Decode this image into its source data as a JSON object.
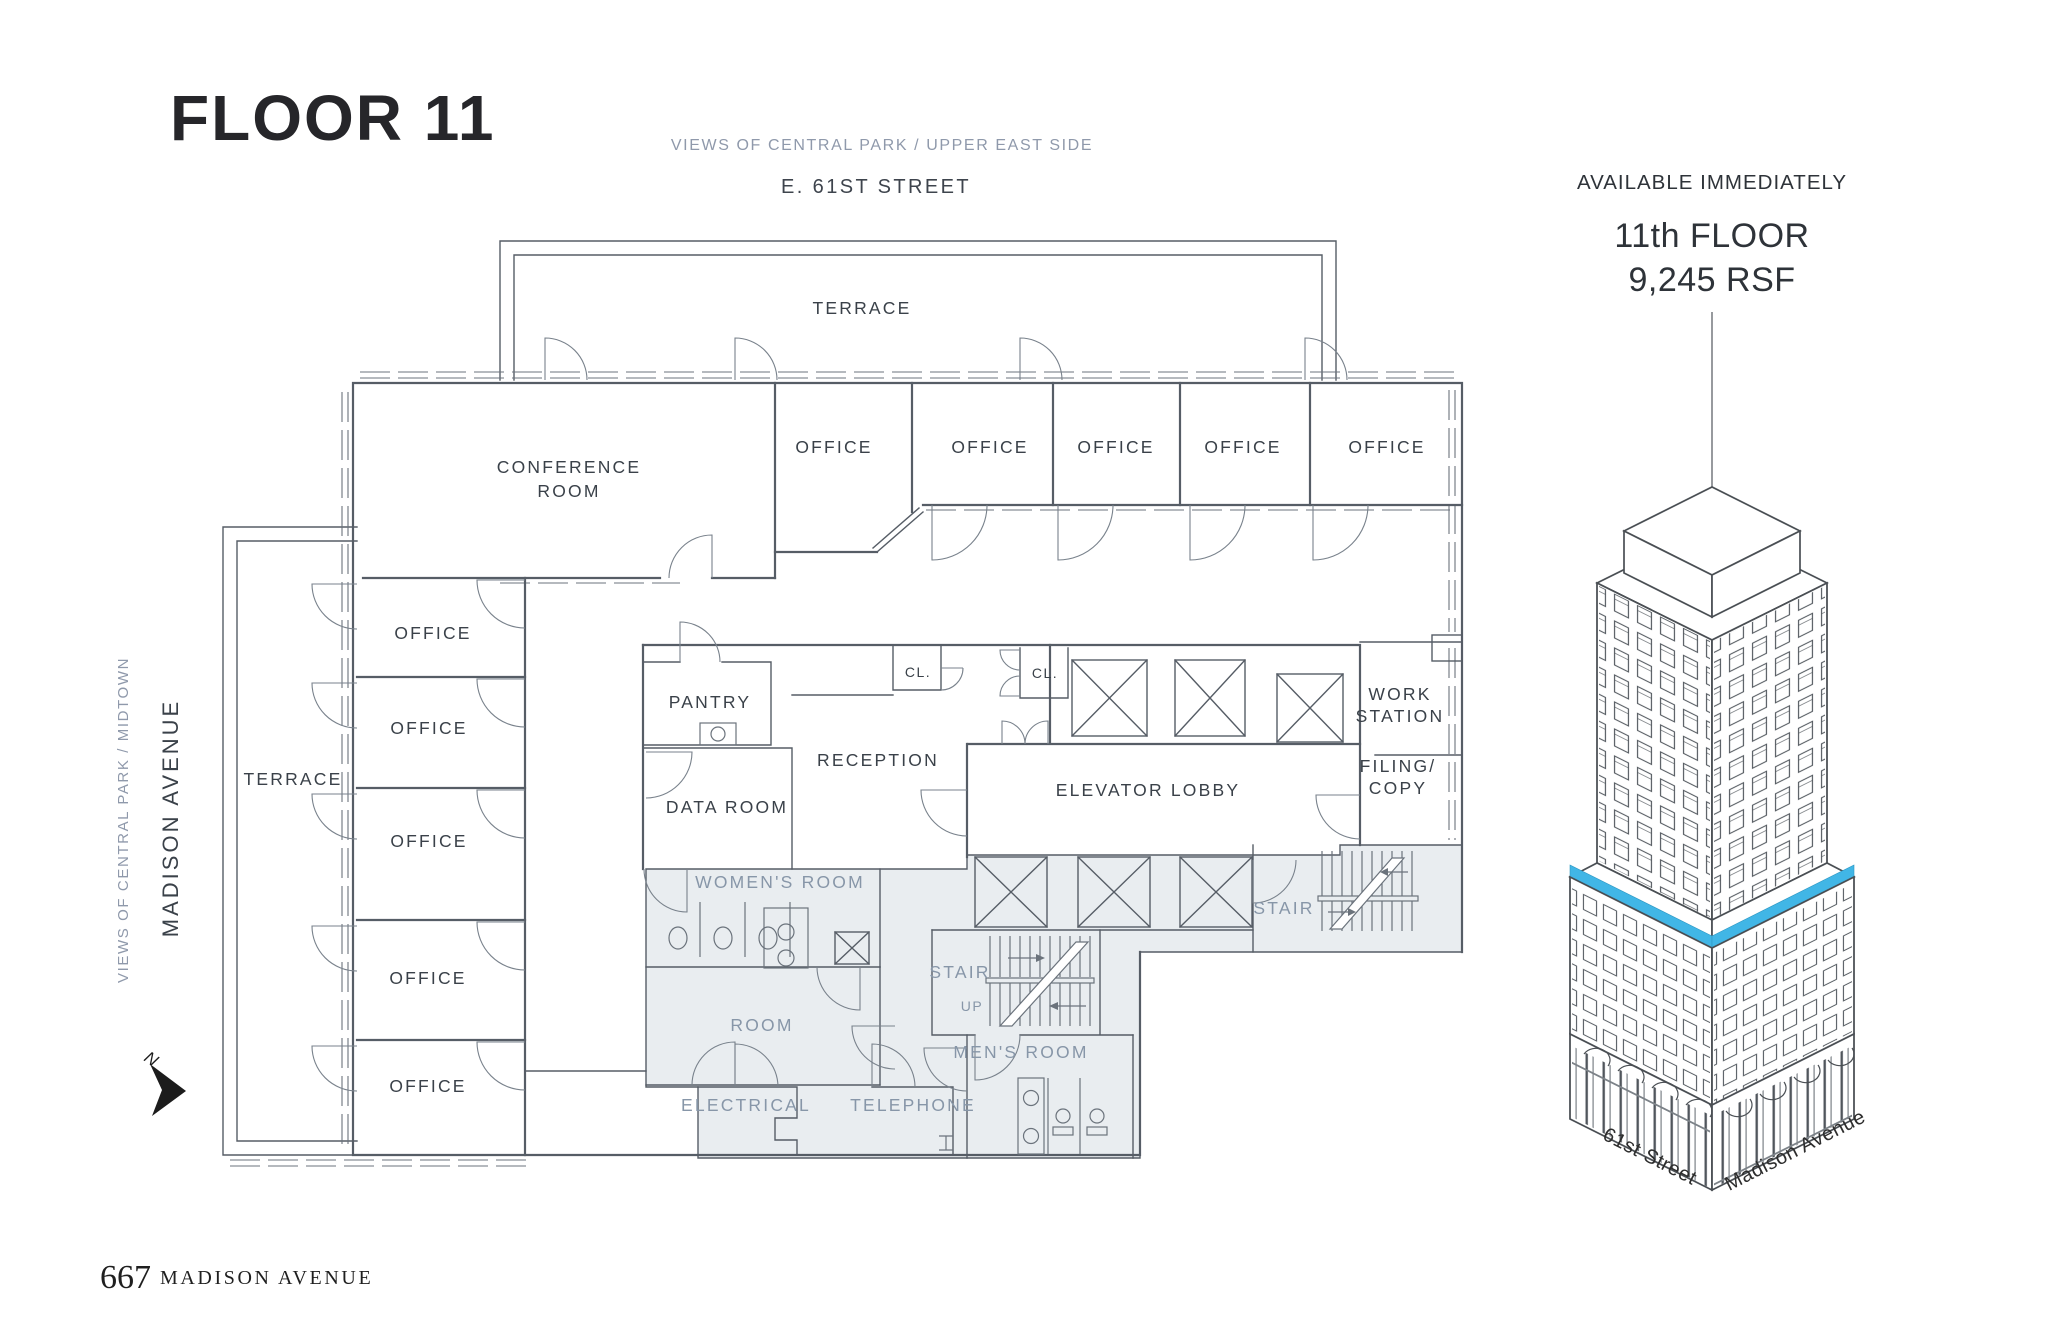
{
  "header": {
    "title": "FLOOR 11",
    "views_note": "VIEWS OF CENTRAL PARK / UPPER EAST SIDE",
    "street": "E. 61ST STREET"
  },
  "availability": {
    "status": "AVAILABLE IMMEDIATELY",
    "floor": "11th FLOOR",
    "area": "9,245 RSF"
  },
  "plan": {
    "labels": {
      "terrace": "TERRACE",
      "conference_line1": "CONFERENCE",
      "conference_line2": "ROOM",
      "office": "OFFICE",
      "pantry": "PANTRY",
      "closet": "CL.",
      "reception": "RECEPTION",
      "data_room": "DATA ROOM",
      "elevator_lobby": "ELEVATOR LOBBY",
      "work_station_line1": "WORK",
      "work_station_line2": "STATION",
      "filing_line1": "FILING/",
      "filing_line2": "COPY",
      "womens_room": "WOMEN'S ROOM",
      "room": "ROOM",
      "stair": "STAIR",
      "up": "UP",
      "mens_room": "MEN'S ROOM",
      "electrical": "ELECTRICAL",
      "telephone": "TELEPHONE"
    },
    "side_views_note": "VIEWS OF CENTRAL PARK / MIDTOWN",
    "side_avenue": "MADISON AVENUE",
    "compass": "N"
  },
  "building": {
    "street_left": "61st Street",
    "street_right": "Madison Avenue"
  },
  "footer": {
    "address_number": "667",
    "address_name": "MADISON AVENUE"
  },
  "colors": {
    "accent": "#41b6e6",
    "core_fill": "#e9edf0",
    "wall": "#565d66",
    "label_dark": "#3a4149",
    "label_core": "#8796a8",
    "label_muted": "#8f99ab"
  }
}
